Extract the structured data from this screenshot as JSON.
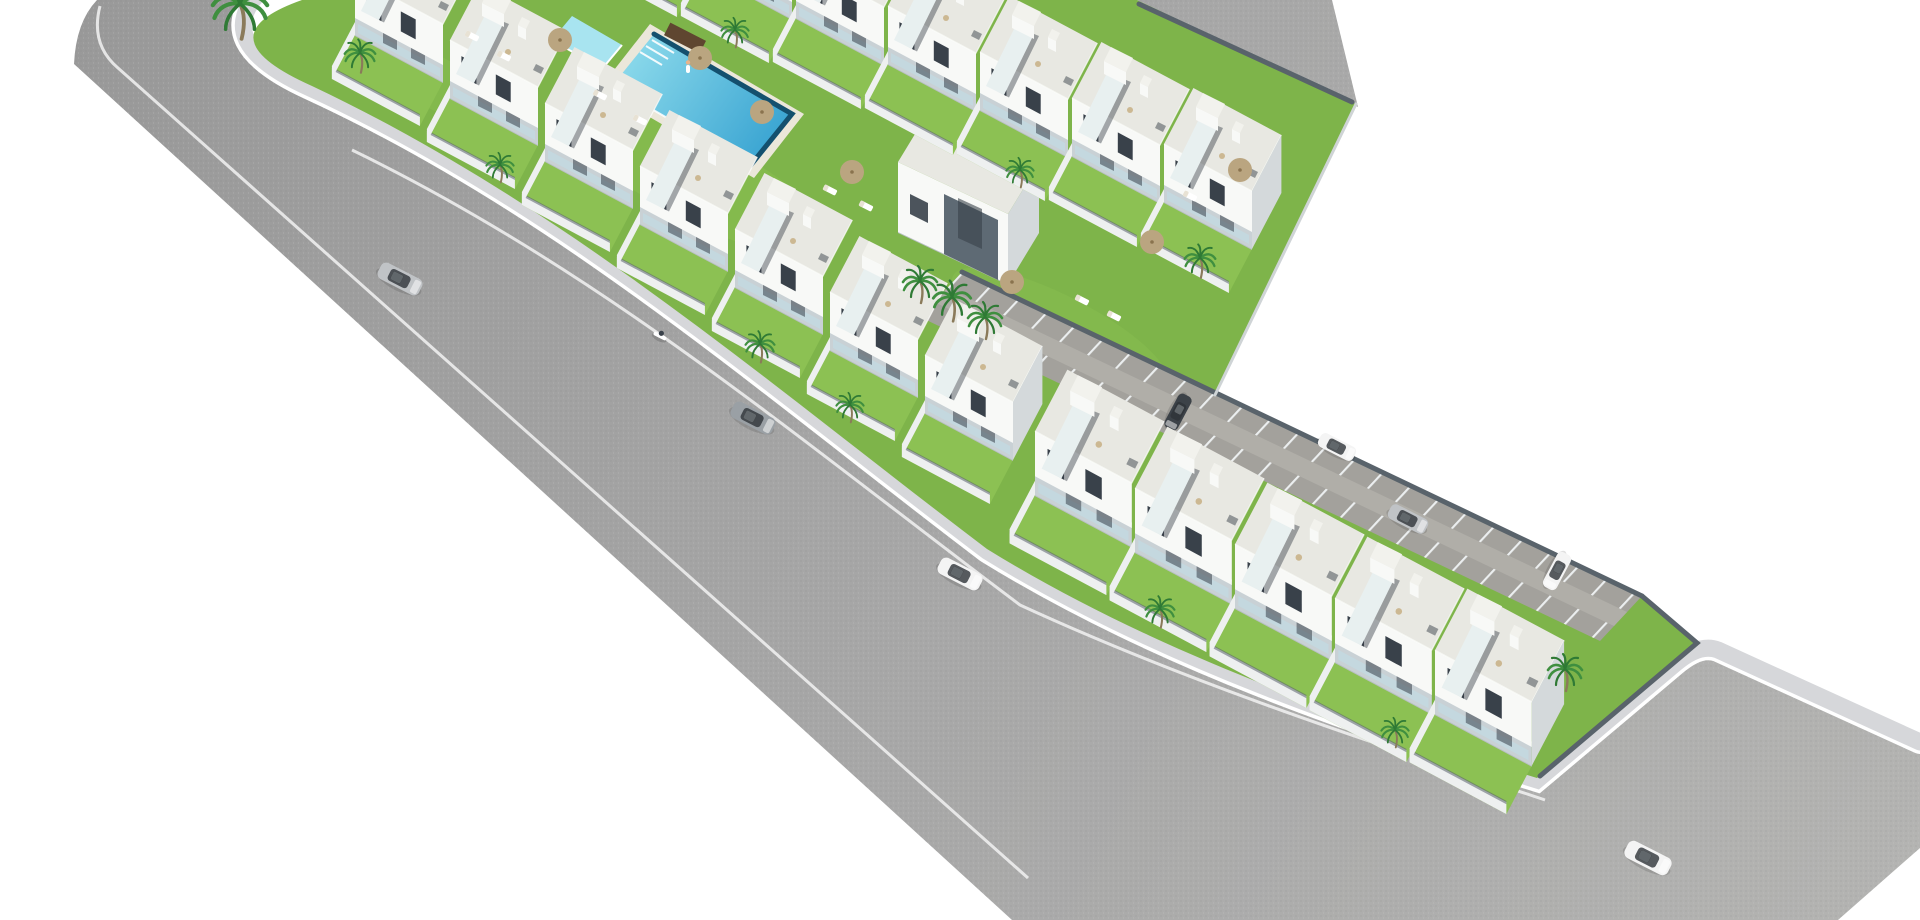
{
  "scene": {
    "type": "aerial-3d-architectural-render",
    "alt": "Aerial 3D render of a new-build white townhouse development arranged diagonally on a white background: two facing rows of two-storey townhouses with roof terraces and external stairs around a communal lawn with a long raised swimming pool and a kids pool, a lower wing of townhouses along a wide gray asphalt road, an angled parking strip with marked bays and parked cars, palm trees, parasols, sun loungers and several cars driving on the surrounding road",
    "background": "#ffffff"
  },
  "colors": {
    "background": "#ffffff",
    "asphalt": "#a7a7a7",
    "asphalt_dark": "#989898",
    "asphalt_light": "#b4b4b2",
    "sidewalk": "#d6d7da",
    "road_line": "#f2f2f2",
    "paver": "#a3a19c",
    "paver_light": "#b0aea8",
    "paver_line": "#eceff0",
    "lawn": "#7eb44a",
    "lawn_light": "#8cc153",
    "deck": "#ebe7da",
    "pool_shallow": "#8fdcec",
    "pool_deep": "#2d9cce",
    "pool_edge": "#14506e",
    "kids_pool": "#a8e4f0",
    "house_white": "#f8f9f7",
    "house_shade": "#d4d9db",
    "house_recess": "#c9d1d5",
    "window": "#39414a",
    "glass": "#c2dae2",
    "roof": "#e8e8e2",
    "roof_light": "#f2f2ed",
    "wall_dark": "#59636b",
    "wall_mid": "#cfd4d6",
    "wall_light": "#eef0f0",
    "base_shadow": "#b9c0c3",
    "villa_accent": "#5e6a74",
    "palm_green": "#3f8f3f",
    "palm_dark": "#2f7a35",
    "trunk": "#8a7a5a",
    "umbrella": "#c9b28a",
    "wood": "#5f4630",
    "car_silver": "#c0c3c6",
    "car_white": "#f4f4f4",
    "car_gray": "#9aa0a5",
    "car_dark": "#3c4248"
  },
  "development": {
    "style": "white modern townhouses with roof terraces and external staircases",
    "rows": [
      {
        "name": "top-row",
        "houses": 8
      },
      {
        "name": "middle-row",
        "houses": 7
      },
      {
        "name": "lower-row",
        "houses": 5
      }
    ],
    "detached_villa": 1,
    "amenities": [
      "communal lawn",
      "lap swimming pool",
      "kids pool",
      "sun loungers",
      "parasols",
      "palm trees",
      "private gardens",
      "parking bays"
    ]
  },
  "pool": {
    "main_pool": 1,
    "kids_pool": 1,
    "swimmer_at_edge": 1
  },
  "vehicles": {
    "cars_on_road": [
      {
        "color_name": "silver"
      },
      {
        "color_name": "gray"
      },
      {
        "color_name": "white"
      },
      {
        "color_name": "white"
      }
    ],
    "cars_parked": [
      {
        "color_name": "dark"
      },
      {
        "color_name": "white"
      },
      {
        "color_name": "silver"
      },
      {
        "color_name": "white"
      }
    ],
    "scooters": 1
  },
  "vegetation": {
    "palm_trees": 14,
    "parasols": 7,
    "loungers": 9
  }
}
